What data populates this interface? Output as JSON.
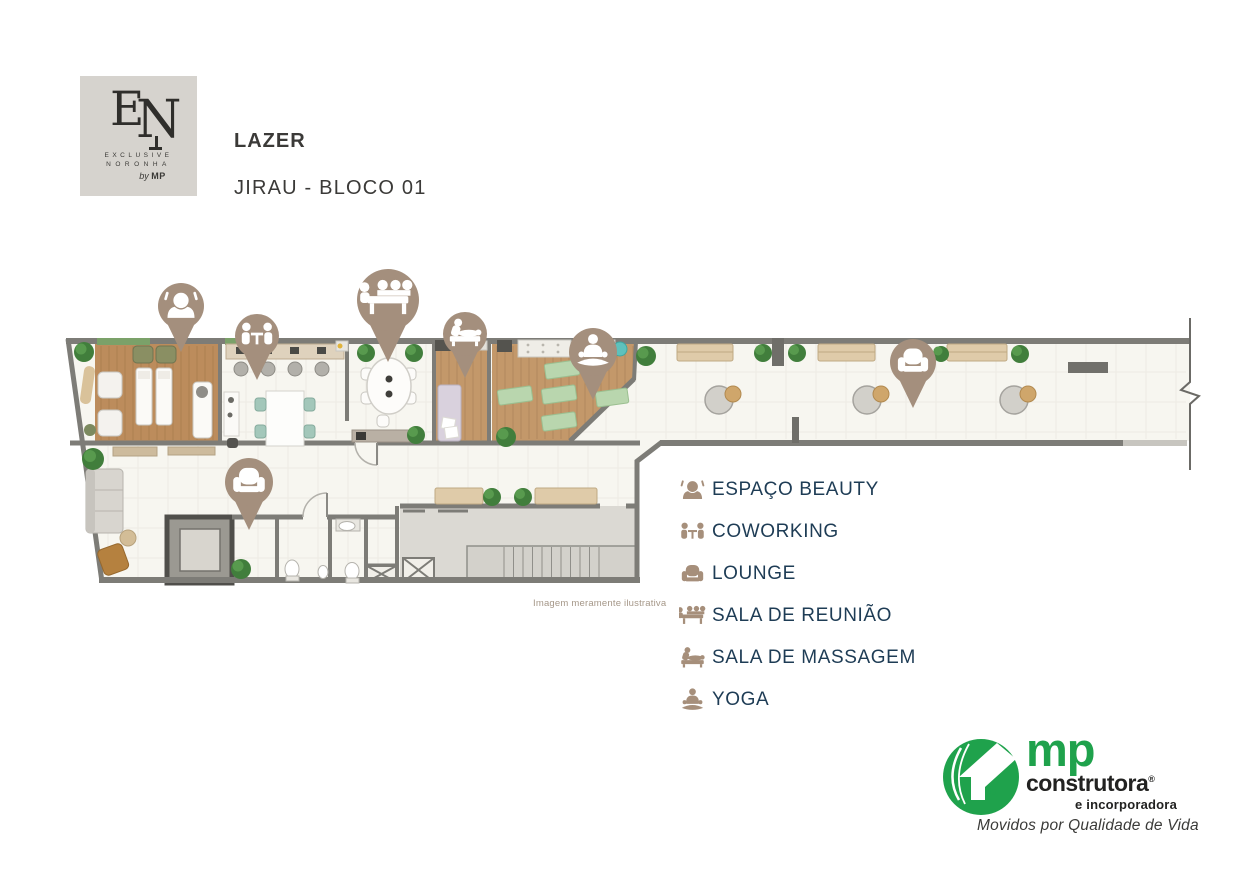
{
  "header": {
    "title": "LAZER",
    "subtitle": "JIRAU - BLOCO 01",
    "logo": {
      "monogram_e": "E",
      "monogram_n": "N",
      "line1": "EXCLUSIVE",
      "line2": "NORONHA",
      "by": "by",
      "brand": "MP",
      "bg_color": "#d6d3ce"
    }
  },
  "legend": {
    "text_color": "#1e3c55",
    "icon_color": "#a68f7b",
    "items": [
      {
        "icon": "espaco-beauty",
        "label": "ESPAÇO BEAUTY"
      },
      {
        "icon": "coworking",
        "label": "COWORKING"
      },
      {
        "icon": "lounge",
        "label": "LOUNGE"
      },
      {
        "icon": "sala-de-reuniao",
        "label": "SALA DE REUNIÃO"
      },
      {
        "icon": "sala-de-massagem",
        "label": "SALA DE MASSAGEM"
      },
      {
        "icon": "yoga",
        "label": "YOGA"
      }
    ]
  },
  "floorplan": {
    "disclaimer": "Imagem meramente ilustrativa",
    "pin_color": "#a48f7d",
    "palette": {
      "wall": "#7d7c77",
      "floor": "#f7f6f0",
      "wood": "#c3986a",
      "yoga_mat_green": "#b9d6ae",
      "bench_wood": "#dfcba9"
    },
    "pins": [
      {
        "icon": "espaco-beauty",
        "x": 181,
        "y": 306,
        "r": 23
      },
      {
        "icon": "coworking",
        "x": 257,
        "y": 336,
        "r": 22
      },
      {
        "icon": "sala-de-reuniao",
        "x": 388,
        "y": 300,
        "r": 31
      },
      {
        "icon": "sala-de-massagem",
        "x": 465,
        "y": 334,
        "r": 22
      },
      {
        "icon": "yoga",
        "x": 593,
        "y": 352,
        "r": 24
      },
      {
        "icon": "lounge",
        "x": 913,
        "y": 362,
        "r": 23
      },
      {
        "icon": "lounge",
        "x": 249,
        "y": 482,
        "r": 24
      }
    ]
  },
  "footer_brand": {
    "name_primary": "mp",
    "name_secondary": "construtora",
    "registered_mark": "®",
    "name_tertiary": "e incorporadora",
    "tagline": "Movidos por Qualidade de Vida",
    "green": "#1fa24c"
  }
}
